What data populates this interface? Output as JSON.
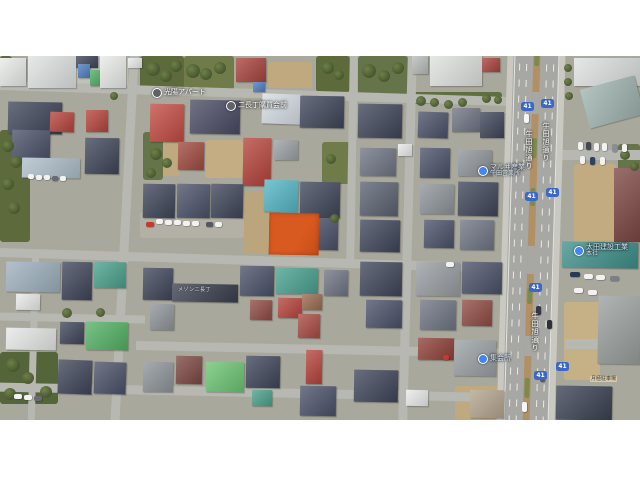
{
  "map": {
    "left": 0,
    "top": 56,
    "width": 640,
    "height": 364,
    "ground_color": "#a9a89c",
    "description": "aerial satellite view of dense Japanese residential blocks with highlighted vacant lot"
  },
  "highlighted_parcel": {
    "x": 269,
    "y": 157,
    "w": 50,
    "h": 42,
    "color": "#d95a20",
    "rot": 1,
    "label": "highlighted-parcel"
  },
  "route_shield_number": "41",
  "road_name": "牛田旭通り",
  "labels": [
    {
      "id": "apartment-label",
      "kind": "place",
      "x": 152,
      "y": 32,
      "text": "光陽アパート"
    },
    {
      "id": "district-label",
      "kind": "place",
      "x": 226,
      "y": 45,
      "text": "二長丁購買会前"
    },
    {
      "id": "business-west-label",
      "kind": "biz",
      "x": 478,
      "y": 108,
      "lines": [
        "マルヰ産業",
        "牛田営業所"
      ]
    },
    {
      "id": "business-east-label",
      "kind": "biz",
      "x": 574,
      "y": 188,
      "lines": [
        "太田建設工業",
        "本社"
      ]
    },
    {
      "id": "hall-label",
      "kind": "biz",
      "x": 478,
      "y": 298,
      "text": "集会所"
    },
    {
      "id": "roof-label",
      "kind": "roof",
      "x": 178,
      "y": 230,
      "text": "メゾン二長丁"
    },
    {
      "id": "parking-sign",
      "kind": "sign",
      "x": 590,
      "y": 320,
      "text": "月極駐車場"
    }
  ],
  "road_names": [
    {
      "x": 524,
      "y": 74
    },
    {
      "x": 541,
      "y": 66
    },
    {
      "x": 530,
      "y": 256
    }
  ],
  "shields": [
    {
      "x": 521,
      "y": 46
    },
    {
      "x": 541,
      "y": 43
    },
    {
      "x": 525,
      "y": 136
    },
    {
      "x": 546,
      "y": 132
    },
    {
      "x": 529,
      "y": 227
    },
    {
      "x": 534,
      "y": 315
    },
    {
      "x": 556,
      "y": 306
    }
  ],
  "scene": {
    "roads": [
      [
        -5,
        33,
        520,
        9,
        1.8
      ],
      [
        -5,
        200,
        522,
        9,
        1.8
      ],
      [
        -3,
        258,
        148,
        8,
        1.2
      ],
      [
        136,
        289,
        380,
        9,
        1.2
      ],
      [
        -4,
        332,
        522,
        9,
        1.2
      ],
      [
        120,
        -5,
        9,
        378,
        3
      ],
      [
        348,
        -4,
        8,
        214,
        1
      ],
      [
        403,
        -5,
        9,
        378,
        1.5
      ],
      [
        28,
        0,
        7,
        34,
        0
      ],
      [
        30,
        196,
        7,
        170,
        1.5
      ],
      [
        562,
        94,
        78,
        10,
        0
      ],
      [
        565,
        283,
        75,
        10,
        0
      ]
    ],
    "avenue": {
      "x": 502,
      "y": -8,
      "w": 58,
      "h": 382,
      "rot": 1.7,
      "walks": [
        [
          0,
          6
        ],
        [
          52,
          6
        ]
      ],
      "median": [
        26,
        7
      ],
      "lanes": [
        12,
        19,
        39,
        46
      ],
      "edges": [
        7,
        51
      ],
      "median_gaps": [
        [
          44,
          22
        ],
        [
          198,
          28
        ],
        [
          288,
          20
        ]
      ],
      "median_veg": [
        [
          2,
          16
        ],
        [
          90,
          20
        ],
        [
          140,
          18
        ],
        [
          240,
          16
        ],
        [
          330,
          20
        ]
      ]
    },
    "patches": [
      [
        0,
        0,
        12,
        26,
        "#5d6b3c"
      ],
      [
        140,
        0,
        44,
        38,
        "#5d6b3c"
      ],
      [
        184,
        0,
        50,
        34,
        "#6f7c4a"
      ],
      [
        268,
        6,
        44,
        26,
        "#c0a97f"
      ],
      [
        316,
        0,
        34,
        36,
        "#5d6b3c"
      ],
      [
        358,
        0,
        50,
        40,
        "#66744a"
      ],
      [
        412,
        36,
        90,
        12,
        "#5f7040"
      ],
      [
        0,
        74,
        30,
        112,
        "#5d6b3c"
      ],
      [
        150,
        82,
        30,
        38,
        "#c0a97f"
      ],
      [
        143,
        76,
        20,
        48,
        "#66744a"
      ],
      [
        205,
        84,
        38,
        38,
        "#c4ad83"
      ],
      [
        243,
        136,
        28,
        62,
        "#bba57c"
      ],
      [
        322,
        86,
        28,
        42,
        "#6f7c4a"
      ],
      [
        0,
        296,
        58,
        52,
        "#55653a"
      ],
      [
        574,
        108,
        42,
        84,
        "#c2ab80"
      ],
      [
        564,
        246,
        36,
        78,
        "#c6b086"
      ],
      [
        618,
        88,
        22,
        36,
        "#66744a"
      ],
      [
        140,
        156,
        104,
        26,
        "#b3b1a6"
      ],
      [
        455,
        330,
        50,
        34,
        "#c0a97f"
      ],
      [
        36,
        0,
        92,
        32,
        "#c2c1b8"
      ]
    ],
    "buildings": [
      [
        0,
        2,
        26,
        28,
        "#e9ebe9",
        0
      ],
      [
        28,
        0,
        48,
        32,
        "#dfe3e2",
        0
      ],
      [
        76,
        0,
        22,
        12,
        "#3e4559",
        0
      ],
      [
        78,
        8,
        12,
        14,
        "#4f7dc0",
        0
      ],
      [
        90,
        14,
        13,
        16,
        "#4fae62",
        0
      ],
      [
        100,
        0,
        26,
        32,
        "#e9ebe9",
        0
      ],
      [
        128,
        2,
        14,
        10,
        "#e9ebe9",
        0
      ],
      [
        236,
        2,
        30,
        24,
        "#a8423c",
        0
      ],
      [
        253,
        26,
        12,
        10,
        "#4f7dc0",
        0
      ],
      [
        412,
        0,
        16,
        18,
        "#b7bcba",
        0
      ],
      [
        430,
        0,
        52,
        30,
        "#dfe2df",
        0
      ],
      [
        482,
        2,
        18,
        14,
        "#a8423c",
        0
      ],
      [
        574,
        2,
        66,
        28,
        "#dde1e0",
        0
      ],
      [
        584,
        26,
        56,
        40,
        "#9fb3af",
        -15
      ],
      [
        8,
        46,
        54,
        32,
        "#3e4559",
        1
      ],
      [
        50,
        56,
        24,
        20,
        "#b5433b",
        2
      ],
      [
        86,
        54,
        22,
        22,
        "#b5433b",
        0
      ],
      [
        12,
        74,
        38,
        30,
        "#4a5168",
        1
      ],
      [
        150,
        48,
        34,
        38,
        "#c24a42",
        1
      ],
      [
        190,
        44,
        50,
        34,
        "#4a4a63",
        1
      ],
      [
        262,
        38,
        40,
        30,
        "#d6dde3",
        2
      ],
      [
        300,
        40,
        44,
        32,
        "#3e4559",
        1
      ],
      [
        358,
        48,
        44,
        34,
        "#3e4559",
        1
      ],
      [
        418,
        56,
        30,
        26,
        "#4a5168",
        2
      ],
      [
        452,
        52,
        28,
        24,
        "#6e7483",
        0
      ],
      [
        480,
        56,
        24,
        26,
        "#3e4559",
        0
      ],
      [
        22,
        102,
        58,
        20,
        "#aebfca",
        1
      ],
      [
        85,
        82,
        34,
        36,
        "#3e4559",
        1
      ],
      [
        178,
        86,
        26,
        28,
        "#a04a3e",
        1
      ],
      [
        243,
        82,
        28,
        48,
        "#b5433b",
        1
      ],
      [
        274,
        84,
        24,
        20,
        "#9ba0a3",
        0
      ],
      [
        360,
        92,
        36,
        28,
        "#6e7483",
        1
      ],
      [
        398,
        88,
        14,
        12,
        "#e9ebe9",
        0
      ],
      [
        420,
        92,
        30,
        30,
        "#4a5168",
        1
      ],
      [
        458,
        94,
        34,
        26,
        "#8e9499",
        0
      ],
      [
        614,
        112,
        26,
        74,
        "#7c4743",
        0
      ],
      [
        264,
        124,
        34,
        32,
        "#53b6c4",
        2
      ],
      [
        300,
        126,
        40,
        36,
        "#3e4559",
        1
      ],
      [
        302,
        162,
        36,
        32,
        "#4a5168",
        1
      ],
      [
        143,
        128,
        32,
        34,
        "#3e4559",
        1
      ],
      [
        177,
        128,
        33,
        34,
        "#4a5168",
        1
      ],
      [
        211,
        128,
        32,
        34,
        "#3e4559",
        1
      ],
      [
        360,
        126,
        38,
        34,
        "#5a6170",
        1
      ],
      [
        360,
        164,
        40,
        32,
        "#3e4559",
        1
      ],
      [
        420,
        128,
        34,
        30,
        "#8e9499",
        1
      ],
      [
        458,
        126,
        40,
        34,
        "#3e4559",
        1
      ],
      [
        424,
        164,
        30,
        28,
        "#4a5168",
        1
      ],
      [
        460,
        164,
        34,
        30,
        "#6e7483",
        1
      ],
      [
        562,
        186,
        76,
        26,
        "#3e8f8a",
        1
      ],
      [
        6,
        206,
        54,
        30,
        "#9db0bd",
        1
      ],
      [
        16,
        238,
        24,
        16,
        "#e9ebe9",
        1
      ],
      [
        62,
        206,
        30,
        38,
        "#3e4559",
        1
      ],
      [
        94,
        206,
        32,
        26,
        "#4aa08a",
        1
      ],
      [
        143,
        212,
        30,
        32,
        "#3e4559",
        1
      ],
      [
        172,
        228,
        66,
        18,
        "#3a3f4e",
        1
      ],
      [
        150,
        248,
        24,
        26,
        "#8e9499",
        1
      ],
      [
        240,
        210,
        34,
        30,
        "#4a5168",
        1
      ],
      [
        276,
        212,
        42,
        26,
        "#48a08f",
        1
      ],
      [
        250,
        244,
        22,
        20,
        "#8f4a42",
        1
      ],
      [
        278,
        242,
        24,
        20,
        "#b5433b",
        1
      ],
      [
        302,
        238,
        20,
        16,
        "#9a6a4e",
        1
      ],
      [
        298,
        258,
        22,
        24,
        "#a84a40",
        1
      ],
      [
        324,
        214,
        24,
        26,
        "#6e7483",
        1
      ],
      [
        360,
        206,
        42,
        34,
        "#3e4559",
        1
      ],
      [
        416,
        206,
        44,
        34,
        "#989da1",
        1
      ],
      [
        462,
        206,
        40,
        32,
        "#4a5168",
        1
      ],
      [
        366,
        244,
        36,
        28,
        "#4a5168",
        1
      ],
      [
        420,
        244,
        36,
        30,
        "#6e7483",
        1
      ],
      [
        462,
        244,
        30,
        26,
        "#8f4a42",
        1
      ],
      [
        6,
        272,
        50,
        22,
        "#e6e8e6",
        1
      ],
      [
        60,
        266,
        24,
        22,
        "#3e4559",
        1
      ],
      [
        86,
        266,
        42,
        28,
        "#52b164",
        1
      ],
      [
        58,
        304,
        34,
        34,
        "#3e4559",
        2
      ],
      [
        94,
        306,
        32,
        32,
        "#4a5168",
        2
      ],
      [
        143,
        306,
        30,
        30,
        "#8e9499",
        1
      ],
      [
        176,
        300,
        26,
        28,
        "#7c4743",
        1
      ],
      [
        206,
        306,
        38,
        30,
        "#6cc473",
        1
      ],
      [
        246,
        300,
        34,
        32,
        "#3e4559",
        1
      ],
      [
        252,
        334,
        20,
        16,
        "#4aa08a",
        1
      ],
      [
        306,
        294,
        16,
        34,
        "#b5433b",
        1
      ],
      [
        300,
        330,
        36,
        30,
        "#4a5168",
        1
      ],
      [
        354,
        314,
        44,
        32,
        "#3e4559",
        1
      ],
      [
        406,
        334,
        22,
        16,
        "#e9ebe9",
        1
      ],
      [
        418,
        282,
        36,
        22,
        "#8f4038",
        1
      ],
      [
        454,
        284,
        42,
        36,
        "#9aa0a4",
        1
      ],
      [
        470,
        334,
        34,
        28,
        "#b3a58e",
        1
      ],
      [
        556,
        330,
        56,
        34,
        "#3a4152",
        1
      ],
      [
        598,
        240,
        42,
        68,
        "#9aa09e",
        1
      ]
    ],
    "cars": [
      [
        146,
        166,
        8,
        5,
        "#c23a30",
        0
      ],
      [
        156,
        163,
        7,
        5,
        "#f2f2f0",
        0
      ],
      [
        165,
        164,
        7,
        5,
        "#f2f2f0",
        0
      ],
      [
        174,
        164,
        7,
        5,
        "#f2f2f0",
        0
      ],
      [
        183,
        165,
        7,
        5,
        "#f2f2f0",
        0
      ],
      [
        192,
        165,
        7,
        5,
        "#f2f2f0",
        0
      ],
      [
        206,
        166,
        7,
        5,
        "#55585e",
        0
      ],
      [
        215,
        166,
        7,
        5,
        "#f2f2f0",
        0
      ],
      [
        28,
        118,
        6,
        5,
        "#f2f2f0",
        0
      ],
      [
        36,
        119,
        6,
        5,
        "#f2f2f0",
        0
      ],
      [
        44,
        119,
        6,
        5,
        "#f2f2f0",
        0
      ],
      [
        52,
        120,
        6,
        5,
        "#686c72",
        0
      ],
      [
        60,
        120,
        6,
        5,
        "#f2f2f0",
        0
      ],
      [
        578,
        86,
        5,
        8,
        "#f2f2f0",
        0
      ],
      [
        586,
        86,
        5,
        8,
        "#45484e",
        0
      ],
      [
        594,
        87,
        5,
        8,
        "#f2f2f0",
        0
      ],
      [
        602,
        87,
        5,
        8,
        "#f2f2f0",
        0
      ],
      [
        612,
        88,
        5,
        8,
        "#8b8e93",
        0
      ],
      [
        622,
        88,
        5,
        8,
        "#f2f2f0",
        0
      ],
      [
        580,
        100,
        5,
        8,
        "#f2f2f0",
        0
      ],
      [
        590,
        101,
        5,
        8,
        "#31415c",
        0
      ],
      [
        600,
        101,
        5,
        8,
        "#f2f2f0",
        0
      ],
      [
        570,
        216,
        10,
        5,
        "#2a3a55",
        0
      ],
      [
        584,
        218,
        9,
        5,
        "#f2f2f0",
        0
      ],
      [
        596,
        219,
        9,
        5,
        "#f2f2f0",
        0
      ],
      [
        610,
        220,
        9,
        5,
        "#7c7f84",
        0
      ],
      [
        574,
        232,
        9,
        5,
        "#f2f2f0",
        0
      ],
      [
        588,
        234,
        9,
        5,
        "#f2f2f0",
        0
      ],
      [
        524,
        58,
        5,
        9,
        "#f6f6f4",
        0
      ],
      [
        536,
        250,
        5,
        9,
        "#35383e",
        0
      ],
      [
        547,
        264,
        5,
        9,
        "#2e3138",
        0
      ],
      [
        522,
        346,
        5,
        10,
        "#f6f6f4",
        0
      ],
      [
        540,
        318,
        5,
        8,
        "#55585e",
        0
      ],
      [
        14,
        338,
        8,
        5,
        "#f2f2f0",
        0
      ],
      [
        24,
        339,
        8,
        5,
        "#f2f2f0",
        0
      ],
      [
        34,
        340,
        8,
        5,
        "#686c72",
        0
      ],
      [
        446,
        206,
        8,
        5,
        "#f2f2f0",
        0
      ],
      [
        443,
        299,
        6,
        5,
        "#c23a30",
        0
      ]
    ],
    "trees": [
      [
        146,
        6,
        14
      ],
      [
        160,
        14,
        12
      ],
      [
        170,
        4,
        12
      ],
      [
        186,
        8,
        14
      ],
      [
        200,
        12,
        12
      ],
      [
        214,
        6,
        12
      ],
      [
        322,
        6,
        12
      ],
      [
        334,
        14,
        10
      ],
      [
        362,
        8,
        14
      ],
      [
        378,
        14,
        12
      ],
      [
        392,
        6,
        12
      ],
      [
        416,
        40,
        10
      ],
      [
        430,
        42,
        9
      ],
      [
        444,
        44,
        9
      ],
      [
        458,
        42,
        9
      ],
      [
        482,
        38,
        9
      ],
      [
        494,
        40,
        8
      ],
      [
        564,
        8,
        8
      ],
      [
        564,
        22,
        8
      ],
      [
        565,
        36,
        8
      ],
      [
        2,
        84,
        12
      ],
      [
        10,
        100,
        12
      ],
      [
        2,
        122,
        12
      ],
      [
        8,
        146,
        12
      ],
      [
        150,
        92,
        12
      ],
      [
        162,
        102,
        10
      ],
      [
        146,
        112,
        10
      ],
      [
        326,
        98,
        10
      ],
      [
        330,
        158,
        9
      ],
      [
        6,
        302,
        14
      ],
      [
        22,
        316,
        12
      ],
      [
        40,
        330,
        12
      ],
      [
        4,
        332,
        12
      ],
      [
        62,
        252,
        10
      ],
      [
        96,
        252,
        9
      ],
      [
        620,
        94,
        10
      ],
      [
        630,
        106,
        9
      ],
      [
        110,
        36,
        8
      ]
    ]
  }
}
